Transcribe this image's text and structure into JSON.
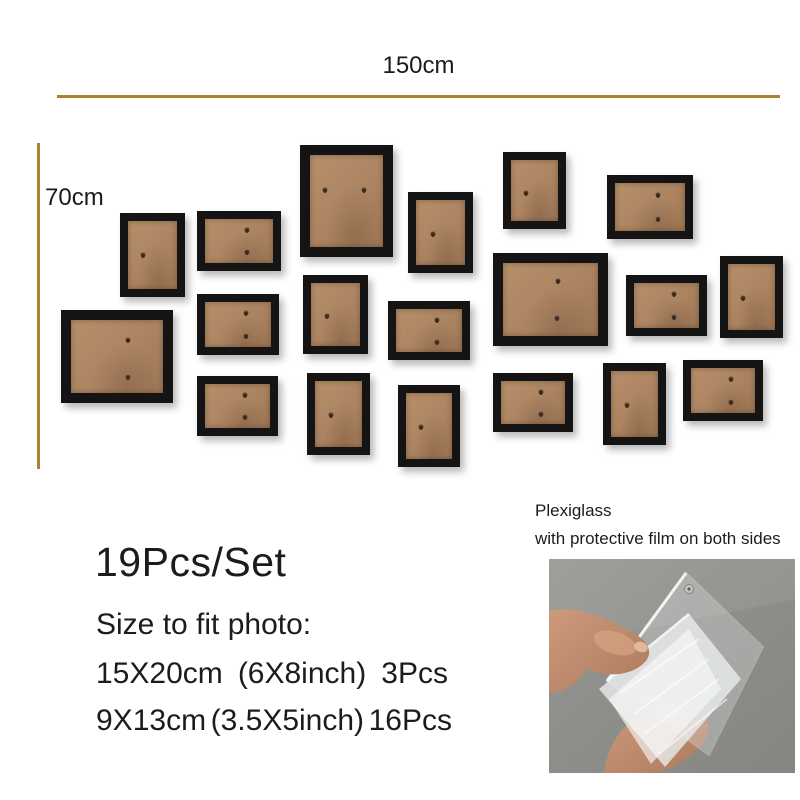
{
  "rulers": {
    "width_label": "150cm",
    "height_label": "70cm"
  },
  "summary": {
    "set_label": "19Pcs/Set",
    "fit_heading": "Size to fit photo:",
    "rows": [
      {
        "cm": "15X20cm",
        "inch": "(6X8inch)",
        "qty": "3Pcs"
      },
      {
        "cm": "9X13cm",
        "inch": "(3.5X5inch)",
        "qty": "16Pcs"
      }
    ]
  },
  "plexiglass_note": {
    "line1": "Plexiglass",
    "line2": "with protective film on both sides"
  },
  "colors": {
    "accent_line": "#a9832f",
    "frame_black": "#141414",
    "board_tan": "#b18a65",
    "text": "#1c1c1c",
    "concrete_gray": "#8b8b87",
    "skin": "#c28e71"
  },
  "frames": [
    {
      "x": 300,
      "y": 145,
      "w": 93,
      "h": 112,
      "size": "large",
      "orient": "portrait",
      "hooks": [
        [
          0.21,
          0.38
        ],
        [
          0.74,
          0.38
        ]
      ]
    },
    {
      "x": 61,
      "y": 310,
      "w": 112,
      "h": 93,
      "size": "large",
      "orient": "landscape",
      "hooks": [
        [
          0.62,
          0.27
        ],
        [
          0.62,
          0.78
        ]
      ]
    },
    {
      "x": 493,
      "y": 253,
      "w": 115,
      "h": 93,
      "size": "large",
      "orient": "landscape",
      "hooks": [
        [
          0.58,
          0.25
        ],
        [
          0.57,
          0.76
        ]
      ]
    },
    {
      "x": 120,
      "y": 213,
      "w": 65,
      "h": 84,
      "size": "small",
      "orient": "portrait",
      "hooks": [
        [
          0.3,
          0.5
        ]
      ]
    },
    {
      "x": 197,
      "y": 211,
      "w": 84,
      "h": 60,
      "size": "small",
      "orient": "landscape",
      "hooks": [
        [
          0.62,
          0.25
        ],
        [
          0.62,
          0.76
        ]
      ]
    },
    {
      "x": 408,
      "y": 192,
      "w": 65,
      "h": 81,
      "size": "small",
      "orient": "portrait",
      "hooks": [
        [
          0.35,
          0.52
        ]
      ]
    },
    {
      "x": 503,
      "y": 152,
      "w": 63,
      "h": 77,
      "size": "small",
      "orient": "portrait",
      "hooks": [
        [
          0.32,
          0.54
        ]
      ]
    },
    {
      "x": 607,
      "y": 175,
      "w": 86,
      "h": 64,
      "size": "small",
      "orient": "landscape",
      "hooks": [
        [
          0.62,
          0.25
        ],
        [
          0.62,
          0.76
        ]
      ]
    },
    {
      "x": 303,
      "y": 275,
      "w": 65,
      "h": 79,
      "size": "small",
      "orient": "portrait",
      "hooks": [
        [
          0.33,
          0.52
        ]
      ]
    },
    {
      "x": 197,
      "y": 294,
      "w": 82,
      "h": 61,
      "size": "small",
      "orient": "landscape",
      "hooks": [
        [
          0.62,
          0.25
        ],
        [
          0.62,
          0.76
        ]
      ]
    },
    {
      "x": 626,
      "y": 275,
      "w": 81,
      "h": 61,
      "size": "small",
      "orient": "landscape",
      "hooks": [
        [
          0.62,
          0.25
        ],
        [
          0.62,
          0.76
        ]
      ]
    },
    {
      "x": 720,
      "y": 256,
      "w": 63,
      "h": 82,
      "size": "small",
      "orient": "portrait",
      "hooks": [
        [
          0.32,
          0.52
        ]
      ]
    },
    {
      "x": 388,
      "y": 301,
      "w": 82,
      "h": 59,
      "size": "small",
      "orient": "landscape",
      "hooks": [
        [
          0.62,
          0.25
        ],
        [
          0.62,
          0.76
        ]
      ]
    },
    {
      "x": 197,
      "y": 376,
      "w": 81,
      "h": 60,
      "size": "small",
      "orient": "landscape",
      "hooks": [
        [
          0.62,
          0.25
        ],
        [
          0.62,
          0.76
        ]
      ]
    },
    {
      "x": 307,
      "y": 373,
      "w": 63,
      "h": 82,
      "size": "small",
      "orient": "portrait",
      "hooks": [
        [
          0.33,
          0.52
        ]
      ]
    },
    {
      "x": 398,
      "y": 385,
      "w": 62,
      "h": 82,
      "size": "small",
      "orient": "portrait",
      "hooks": [
        [
          0.33,
          0.52
        ]
      ]
    },
    {
      "x": 493,
      "y": 373,
      "w": 80,
      "h": 59,
      "size": "small",
      "orient": "landscape",
      "hooks": [
        [
          0.62,
          0.25
        ],
        [
          0.62,
          0.76
        ]
      ]
    },
    {
      "x": 603,
      "y": 363,
      "w": 63,
      "h": 82,
      "size": "small",
      "orient": "portrait",
      "hooks": [
        [
          0.33,
          0.52
        ]
      ]
    },
    {
      "x": 683,
      "y": 360,
      "w": 80,
      "h": 61,
      "size": "small",
      "orient": "landscape",
      "hooks": [
        [
          0.62,
          0.25
        ],
        [
          0.62,
          0.76
        ]
      ]
    }
  ]
}
